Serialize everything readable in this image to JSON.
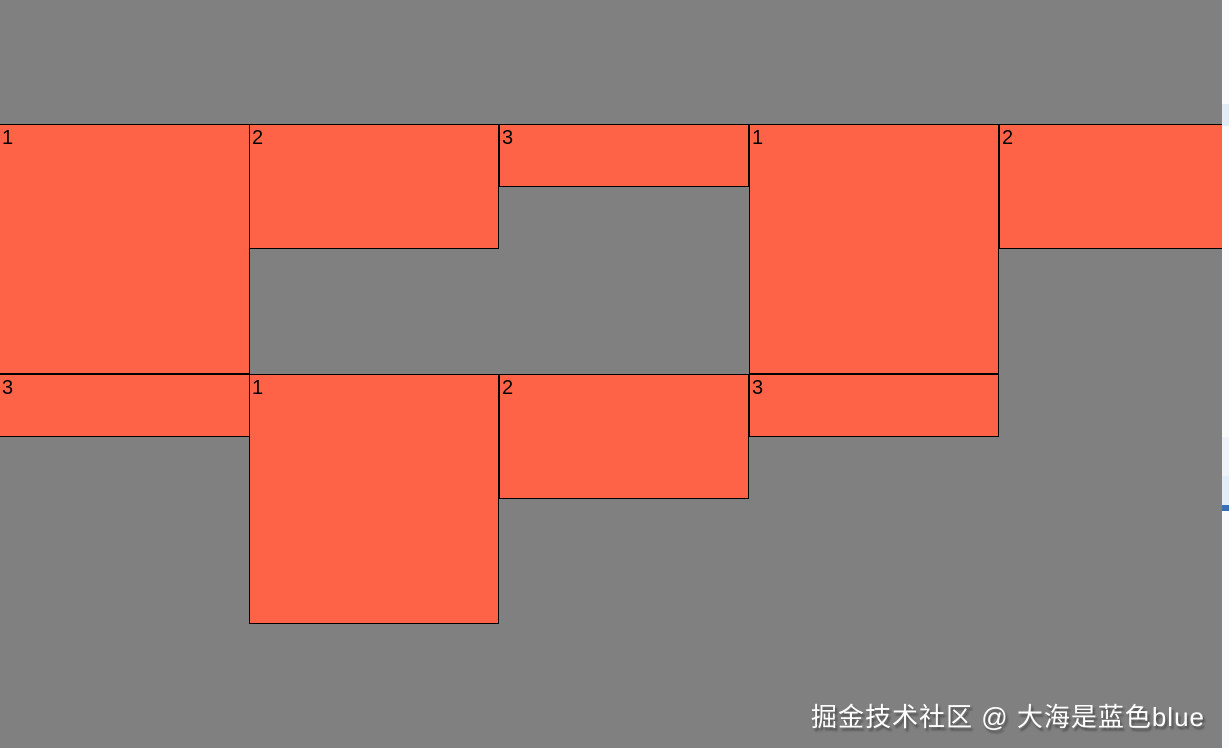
{
  "page": {
    "watermark": "掘金技术社区 @ 大海是蓝色blue"
  },
  "colors": {
    "page_bg": "#808080",
    "box_fill": "#ff6347",
    "box_border": "#000000",
    "watermark_text": "#ffffff",
    "watermark_shadow": "#4d4d4d",
    "scrollbar_track": "#fafbfd",
    "scrollbar_marker": "#e3edf8",
    "scrollbar_marker_faint": "#eff4fb",
    "scrollbar_accent": "#3a6fb5"
  },
  "boxes": [
    {
      "label": "1"
    },
    {
      "label": "2"
    },
    {
      "label": "3"
    },
    {
      "label": "1"
    },
    {
      "label": "2"
    },
    {
      "label": "3"
    },
    {
      "label": "1"
    },
    {
      "label": "2"
    },
    {
      "label": "3"
    }
  ]
}
